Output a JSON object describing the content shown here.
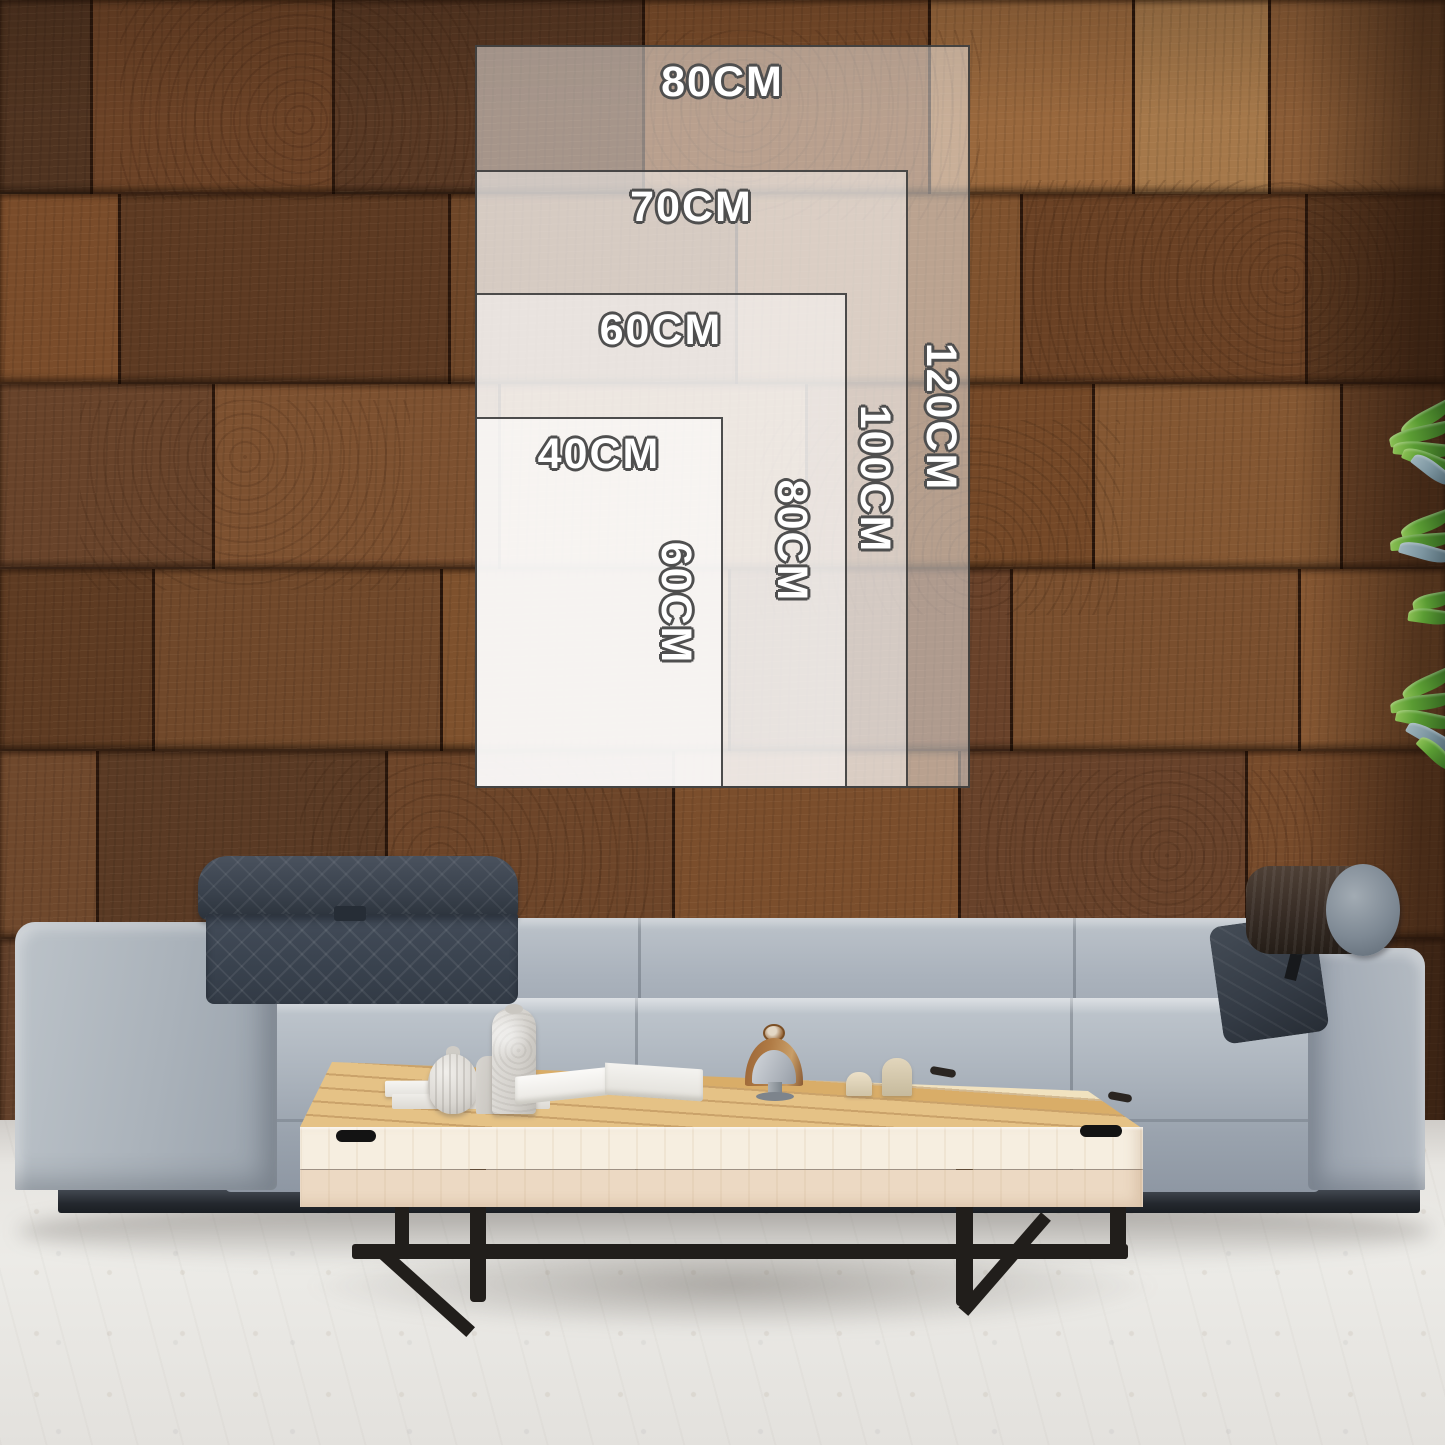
{
  "size_guide": {
    "unit": "CM",
    "sizes": [
      {
        "id": "size-80x120",
        "width_cm": 80,
        "height_cm": 120,
        "width_label": "80CM",
        "height_label": "120CM"
      },
      {
        "id": "size-70x100",
        "width_cm": 70,
        "height_cm": 100,
        "width_label": "70CM",
        "height_label": "100CM"
      },
      {
        "id": "size-60x80",
        "width_cm": 60,
        "height_cm": 80,
        "width_label": "60CM",
        "height_label": "80CM"
      },
      {
        "id": "size-40x60",
        "width_cm": 40,
        "height_cm": 60,
        "width_label": "40CM",
        "height_label": "60CM"
      }
    ],
    "label_color": "#ffffff",
    "label_outline_color": "#4f4f4f",
    "panel_fill": "rgba(255,255,255,0.47)",
    "panel_border_color": "#343434"
  },
  "colors": {
    "wall_wood": "#6f4528",
    "sofa_fabric": "#aab2bc",
    "headrest_fabric": "#3c4450",
    "bolster_leather": "#372c25",
    "table_top_wood": "#ddb273",
    "table_front_wood": "#f2e8d8",
    "table_legs": "#211e1b",
    "floor": "#e9e7e4",
    "plant_leaves": "#4e8f2d"
  }
}
